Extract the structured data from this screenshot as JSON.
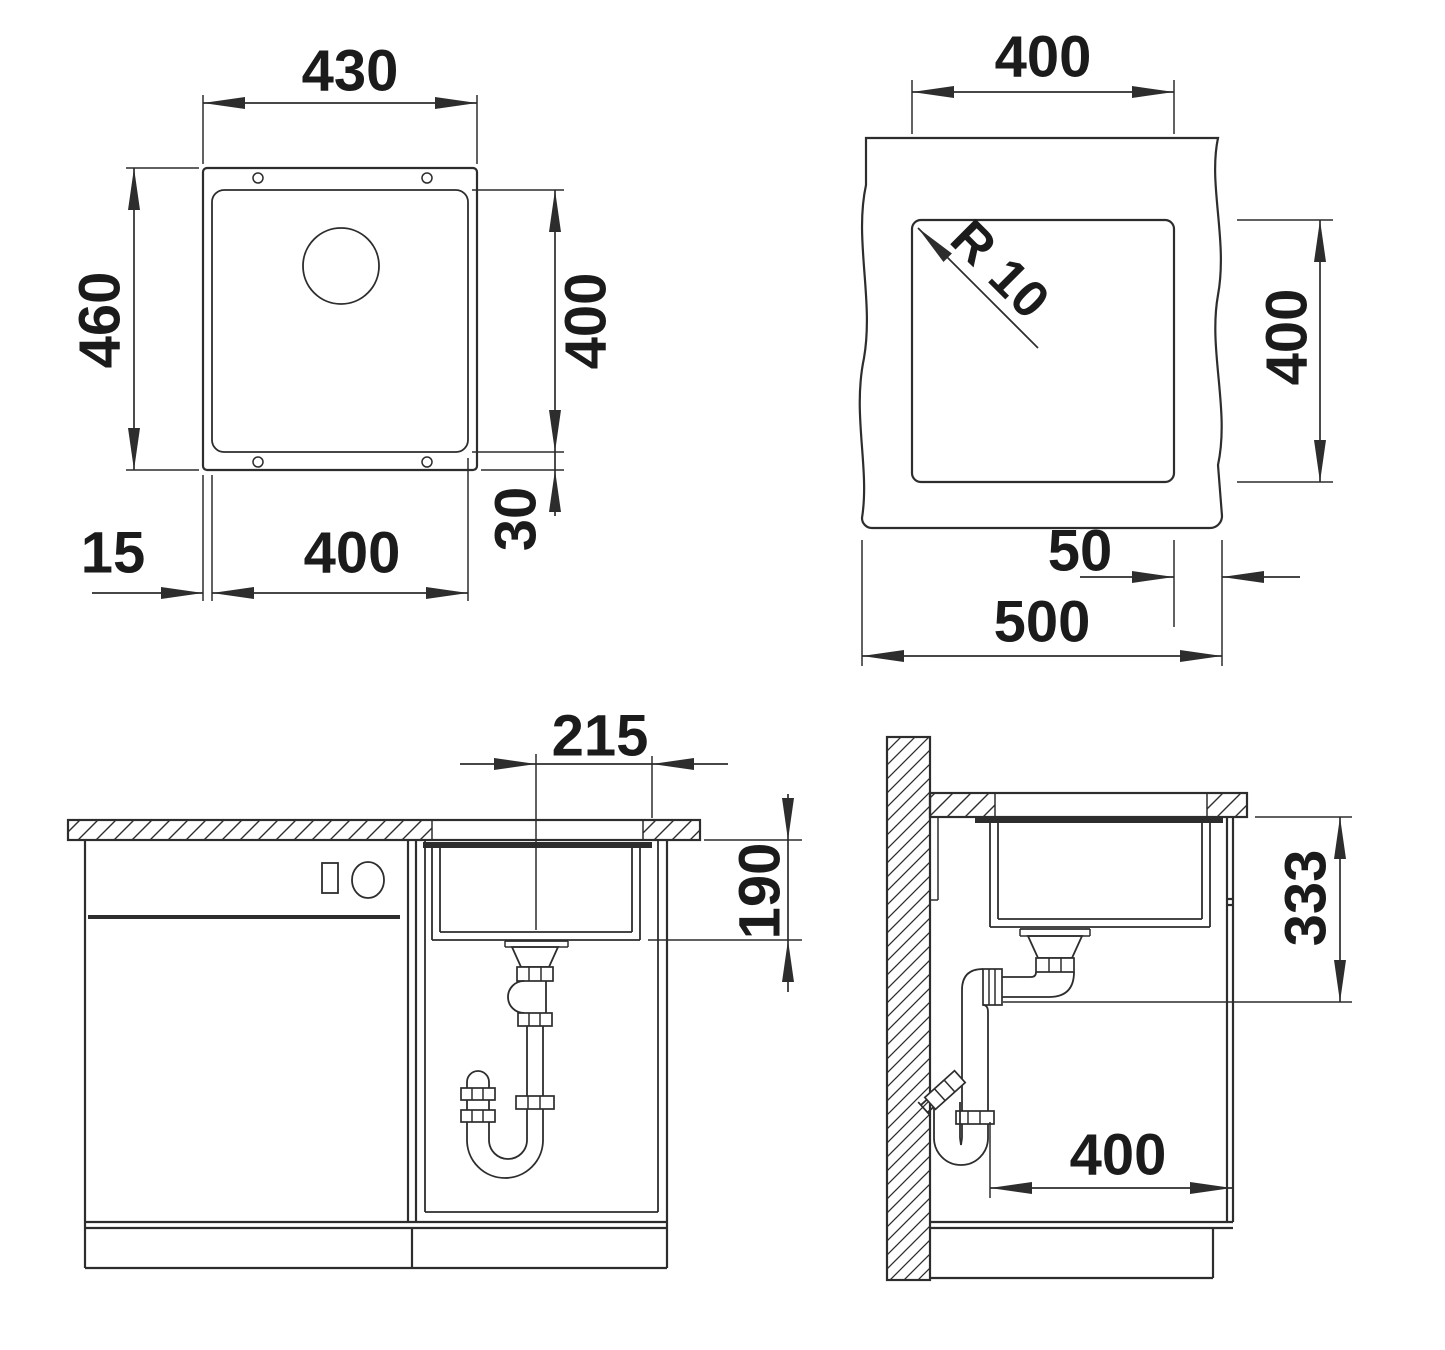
{
  "colors": {
    "background": "#ffffff",
    "line": "#2d2d2d",
    "text": "#1b1b1b"
  },
  "views": {
    "top": {
      "overall_width": "430",
      "overall_depth": "460",
      "bowl_depth": "400",
      "rim_bottom": "30",
      "rim_side": "15",
      "bowl_width": "400"
    },
    "cutout": {
      "cutout_width": "400",
      "corner_radius": "R 10",
      "cutout_depth": "400",
      "edge_distance": "50",
      "worktop_width": "500"
    },
    "front": {
      "drain_offset": "215",
      "bowl_inner_depth": "190"
    },
    "side": {
      "outlet_height": "333",
      "clearance_depth": "400"
    }
  }
}
